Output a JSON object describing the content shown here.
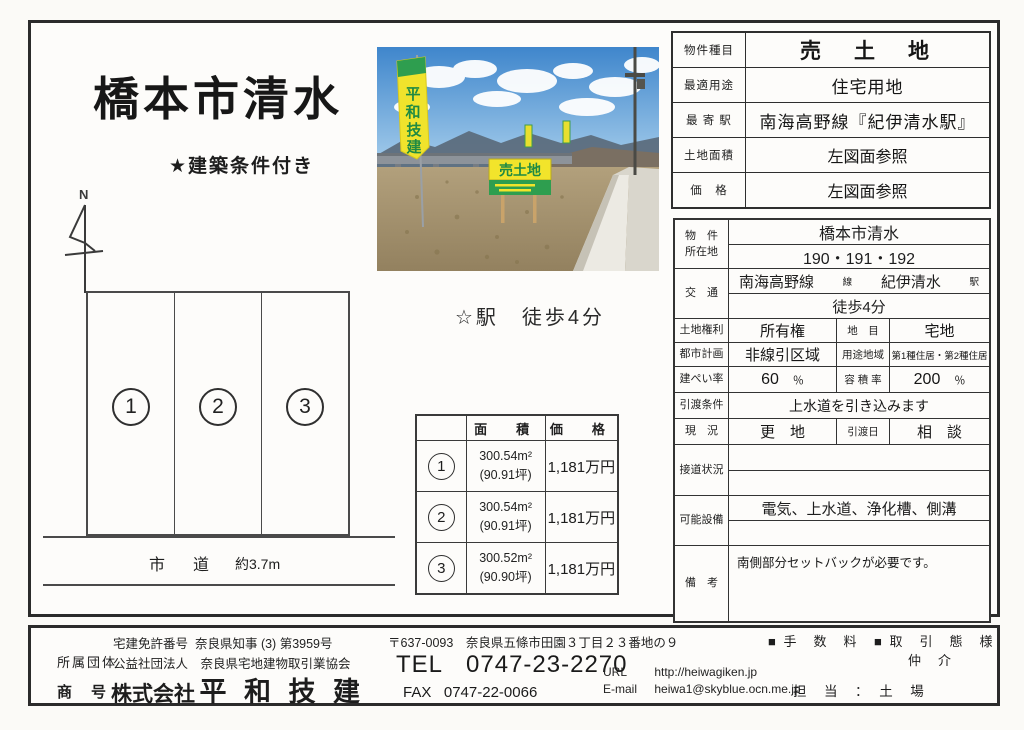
{
  "page": {
    "title": "橋本市清水",
    "subtitle": "★建築条件付き",
    "north_label": "N",
    "station_note": "☆駅　徒歩4分"
  },
  "diagram": {
    "plots": [
      "1",
      "2",
      "3"
    ],
    "road_label": "市　道",
    "road_width": "約3.7m"
  },
  "photo": {
    "sign_text": "売土地",
    "banner_chars": [
      "平",
      "和",
      "技",
      "建"
    ]
  },
  "price_table": {
    "corner": "",
    "headers": [
      "面　積",
      "価　格"
    ],
    "rows": [
      {
        "no": "1",
        "area_m2": "300.54m²",
        "area_tsubo": "(90.91坪)",
        "price": "1,181万円"
      },
      {
        "no": "2",
        "area_m2": "300.54m²",
        "area_tsubo": "(90.91坪)",
        "price": "1,181万円"
      },
      {
        "no": "3",
        "area_m2": "300.52m²",
        "area_tsubo": "(90.90坪)",
        "price": "1,181万円"
      }
    ]
  },
  "summary": {
    "rows": [
      {
        "label": "物件種目",
        "value": "売　土　地"
      },
      {
        "label": "最適用途",
        "value": "住宅用地"
      },
      {
        "label": "最 寄 駅",
        "value": "南海高野線『紀伊清水駅』"
      },
      {
        "label": "土地面積",
        "value": "左図面参照"
      },
      {
        "label": "価　格",
        "value": "左図面参照"
      }
    ]
  },
  "detail": {
    "location": {
      "label1": "物　件",
      "label2": "所在地",
      "value1": "橋本市清水",
      "value2": "190・191・192"
    },
    "access": {
      "label": "交　通",
      "line": "南海高野線",
      "line_suffix": "線",
      "station": "紀伊清水",
      "station_suffix": "駅",
      "walk": "徒歩4分"
    },
    "rights": {
      "label": "土地権利",
      "value": "所有権",
      "label2": "地　目",
      "value2": "宅地"
    },
    "planning": {
      "label": "都市計画",
      "value": "非線引区域",
      "label2": "用途地域",
      "value2": "第1種住居・第2種住居"
    },
    "coverage": {
      "label": "建ぺい率",
      "value": "60",
      "unit": "％",
      "label2": "容 積 率",
      "value2": "200",
      "unit2": "％"
    },
    "handover": {
      "label": "引渡条件",
      "value": "上水道を引き込みます"
    },
    "current": {
      "label": "現　況",
      "value": "更　地",
      "label2": "引渡日",
      "value2": "相　談"
    },
    "road_contact": {
      "label": "接道状況",
      "value": ""
    },
    "utilities": {
      "label": "可能設備",
      "value": "電気、上水道、浄化槽、側溝"
    },
    "remarks": {
      "label": "備　考",
      "value": "南側部分セットバックが必要です。"
    }
  },
  "footer": {
    "license_label": "宅建免許番号",
    "license": "奈良県知事 (3) 第3959号",
    "org_label": "所属団体",
    "org": "公益社団法人　奈良県宅地建物取引業協会",
    "trade_name_label": "商　号",
    "company_prefix": "株式会社",
    "company_name": "平 和 技 建",
    "postal": "〒637-0093　奈良県五條市田園３丁目２３番地の９",
    "tel_label": "TEL",
    "tel": "0747-23-2270",
    "fax_label": "FAX",
    "fax": "0747-22-0066",
    "url_label": "URL",
    "url": "http://heiwagiken.jp",
    "email_label": "E-mail",
    "email": "heiwa1@skyblue.ocn.me.jp",
    "fee_label": "■ 手　数　料",
    "type_label": "■ 取　引　態　様",
    "type_value": "仲　介",
    "staff": "担　当　：　土　場"
  }
}
